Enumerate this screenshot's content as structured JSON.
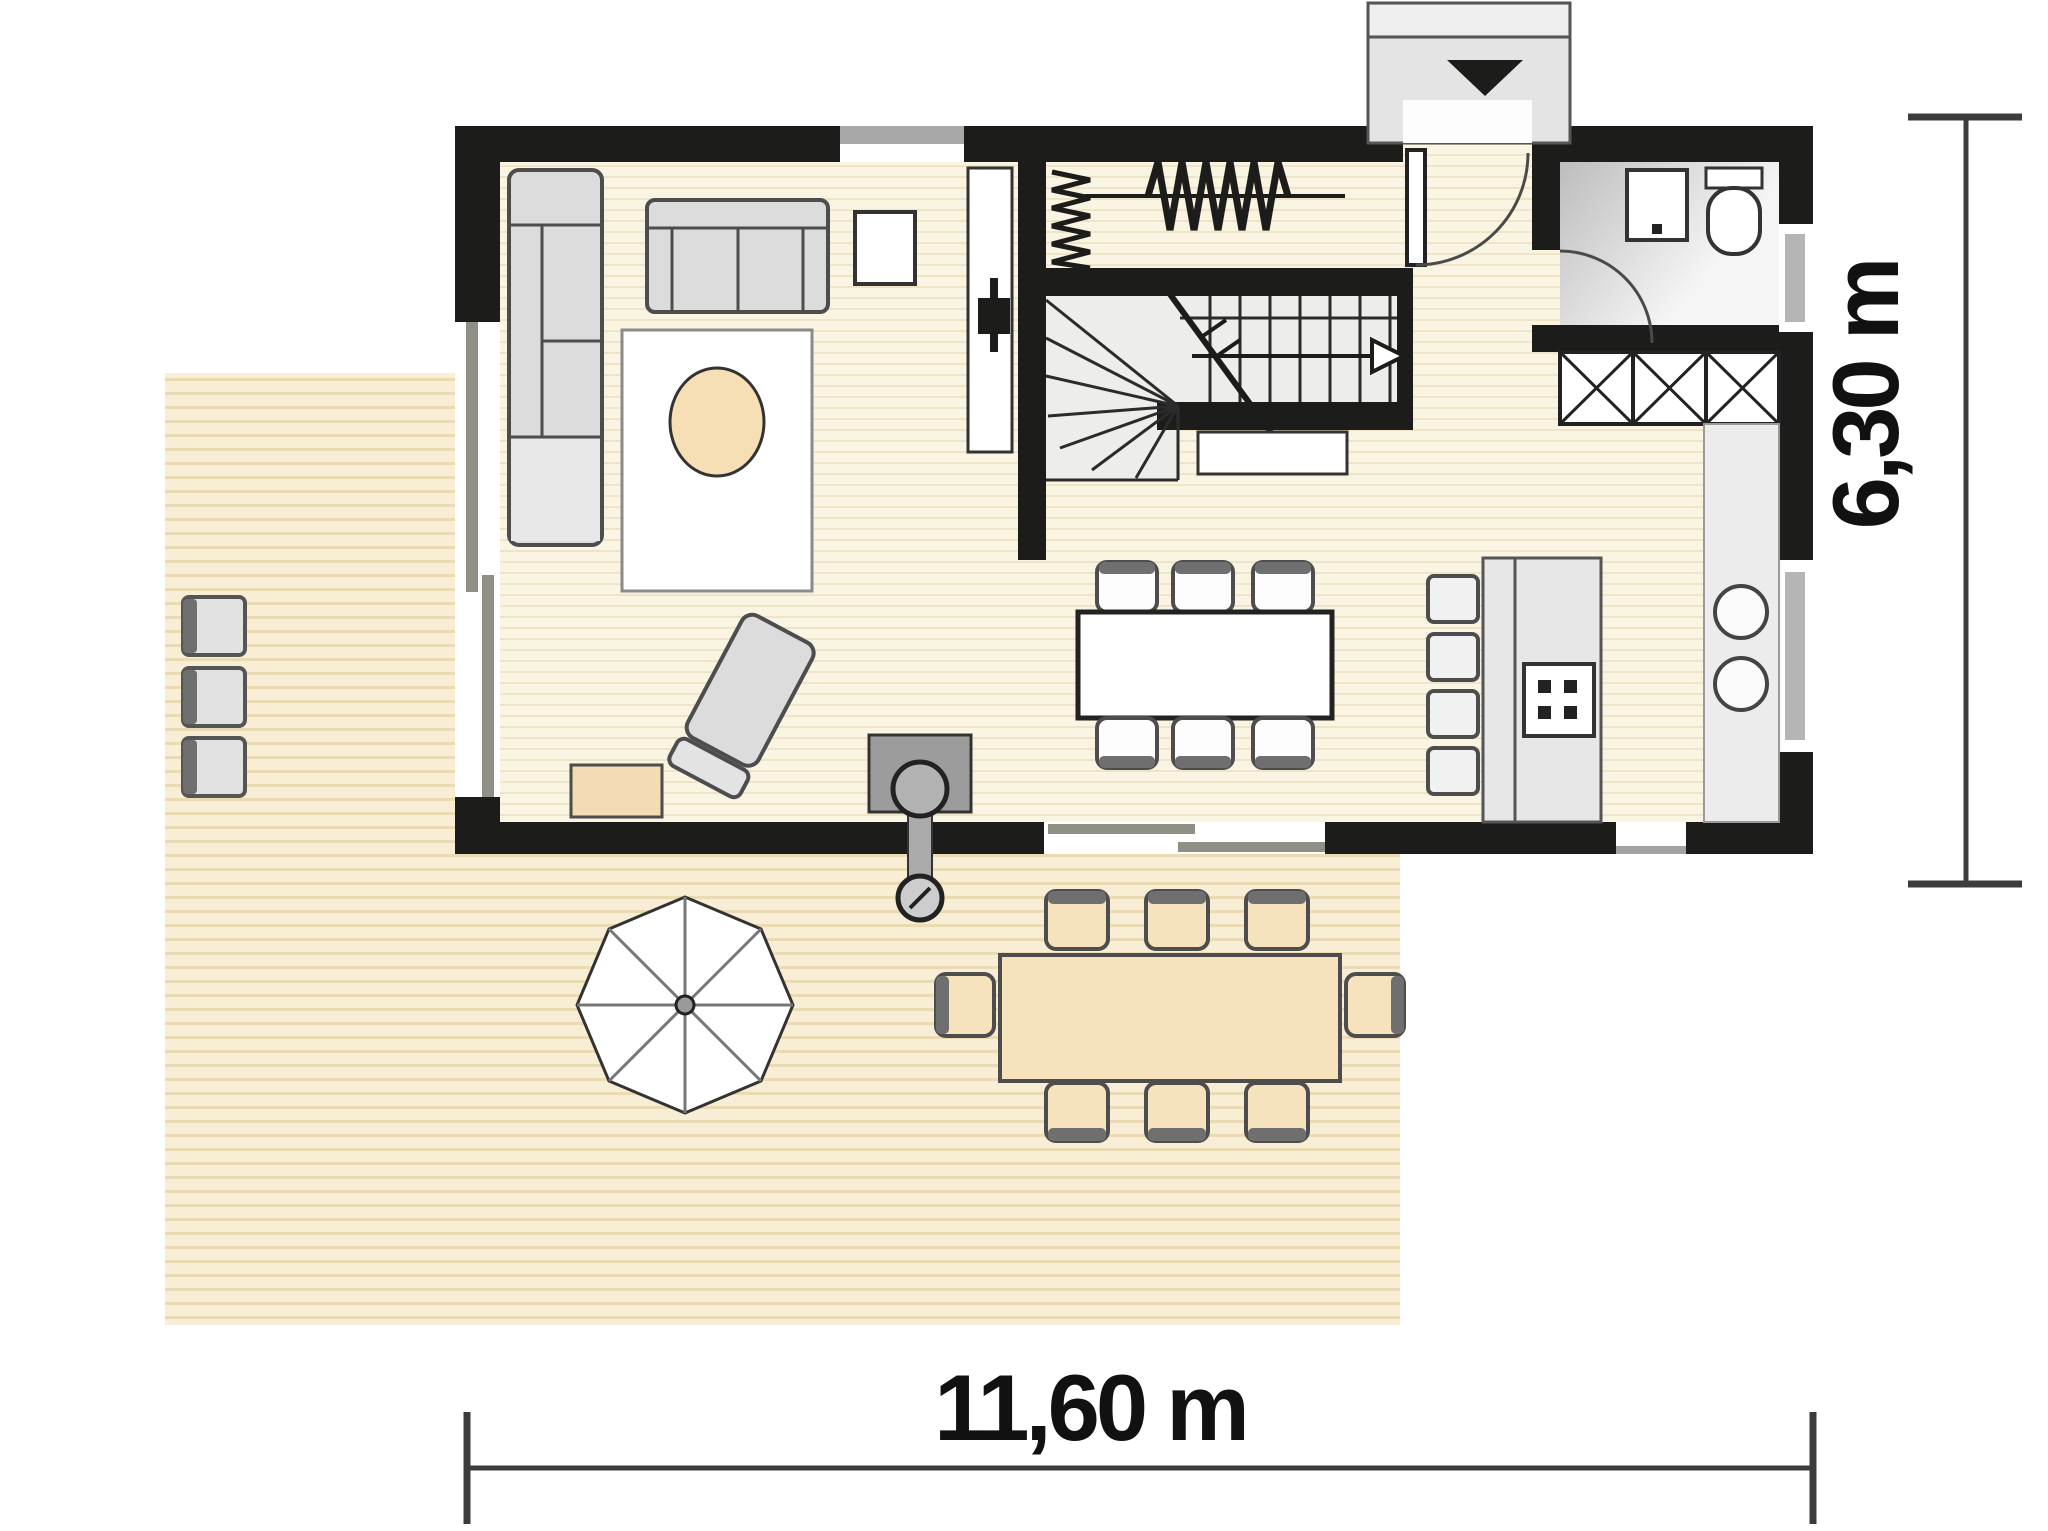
{
  "dimensions": {
    "bottom_label": "11,60 m",
    "right_label": "6,30 m"
  },
  "theme": {
    "wall": "#1c1c1a",
    "floor_base": "#faf4e3",
    "floor_stripe": "#efe3c8",
    "terrace_base": "#f8eed6",
    "terrace_stripe": "#eadbb4",
    "furniture_gray": "#dcdcdc",
    "furniture_light": "#ececec",
    "accent_beige": "#f6e3bd",
    "outline": "#4d4d4d",
    "dim_text": "#111111",
    "bath_dark": "#bdbdbd",
    "bath_light": "#f5f5f5"
  },
  "symbols": {
    "entrance_arrow": "▼",
    "stair_direction_arrow": "▷",
    "door_swing": "quarter-arc",
    "radiator_zigzag": "WWW",
    "closet_cross": "X"
  }
}
